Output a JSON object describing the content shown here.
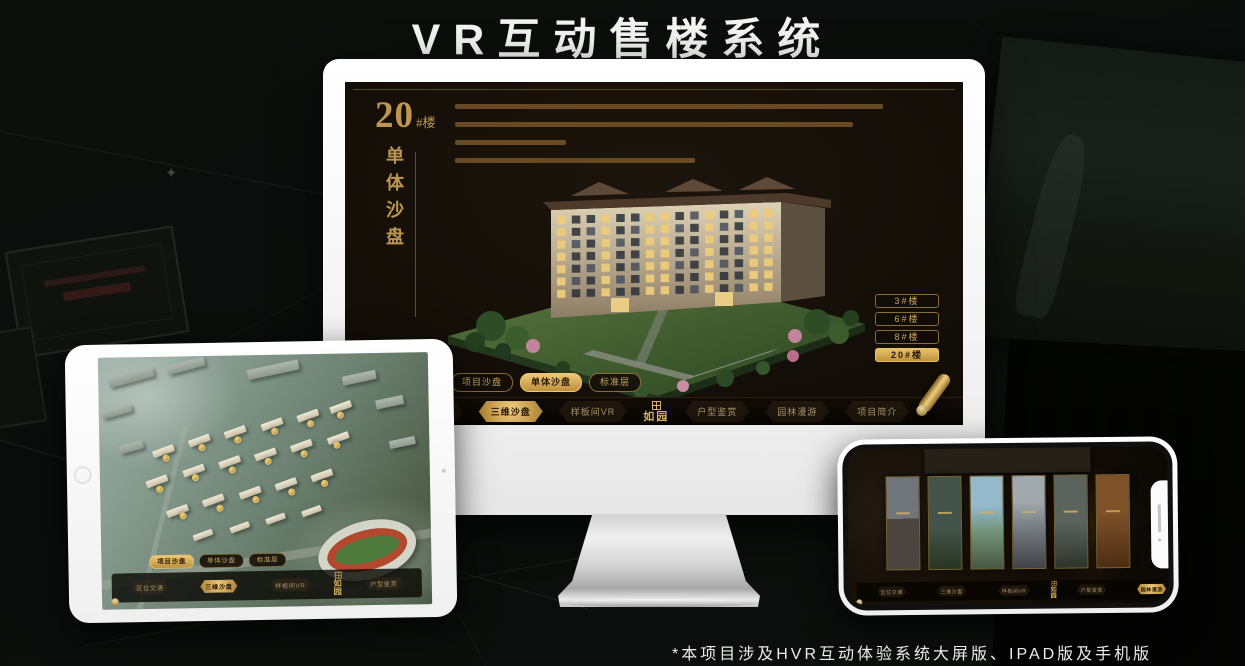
{
  "title": "VR互动售楼系统",
  "footnote": "*本项目涉及HVR互动体验系统大屏版、IPAD版及手机版",
  "colors": {
    "gold": "#c9a35c",
    "gold_active": "#e7c269",
    "screen_bg": "#130d07",
    "page_bg": "#0b0e0c"
  },
  "monitor": {
    "building_title_number": "20",
    "building_title_suffix": "#楼",
    "building_title_vertical": "单体沙盘",
    "floor_buttons": [
      {
        "label": "3#楼",
        "active": false
      },
      {
        "label": "6#楼",
        "active": false
      },
      {
        "label": "8#楼",
        "active": false
      },
      {
        "label": "20#楼",
        "active": true
      }
    ],
    "subtabs": [
      {
        "label": "项目沙盘",
        "active": false
      },
      {
        "label": "单体沙盘",
        "active": true
      },
      {
        "label": "标准层",
        "active": false
      }
    ],
    "menu_left": [
      {
        "label": "区位交通",
        "active": false
      },
      {
        "label": "三维沙盘",
        "active": true
      },
      {
        "label": "样板间VR",
        "active": false
      }
    ],
    "menu_right": [
      {
        "label": "户型鉴赏",
        "active": false
      },
      {
        "label": "园林漫游",
        "active": false
      },
      {
        "label": "项目简介",
        "active": false
      }
    ],
    "logo": "如园"
  },
  "tablet": {
    "subtabs": [
      {
        "label": "项目沙盘",
        "active": true
      },
      {
        "label": "单体沙盘",
        "active": false
      },
      {
        "label": "标准层",
        "active": false
      }
    ],
    "menu_left": [
      {
        "label": "区位交通",
        "active": false
      },
      {
        "label": "三维沙盘",
        "active": true
      },
      {
        "label": "样板间VR",
        "active": false
      }
    ],
    "menu_right": [
      {
        "label": "户型鉴赏",
        "active": false
      },
      {
        "label": "园林漫游",
        "active": false
      },
      {
        "label": "项目简介",
        "active": false
      }
    ],
    "logo": "如园"
  },
  "phone": {
    "menu_left": [
      {
        "label": "区位交通",
        "active": false
      },
      {
        "label": "三维沙盘",
        "active": false
      },
      {
        "label": "样板间VR",
        "active": false
      }
    ],
    "menu_right": [
      {
        "label": "户型鉴赏",
        "active": false
      },
      {
        "label": "园林漫游",
        "active": true
      },
      {
        "label": "项目简介",
        "active": false
      }
    ],
    "logo": "如园"
  }
}
